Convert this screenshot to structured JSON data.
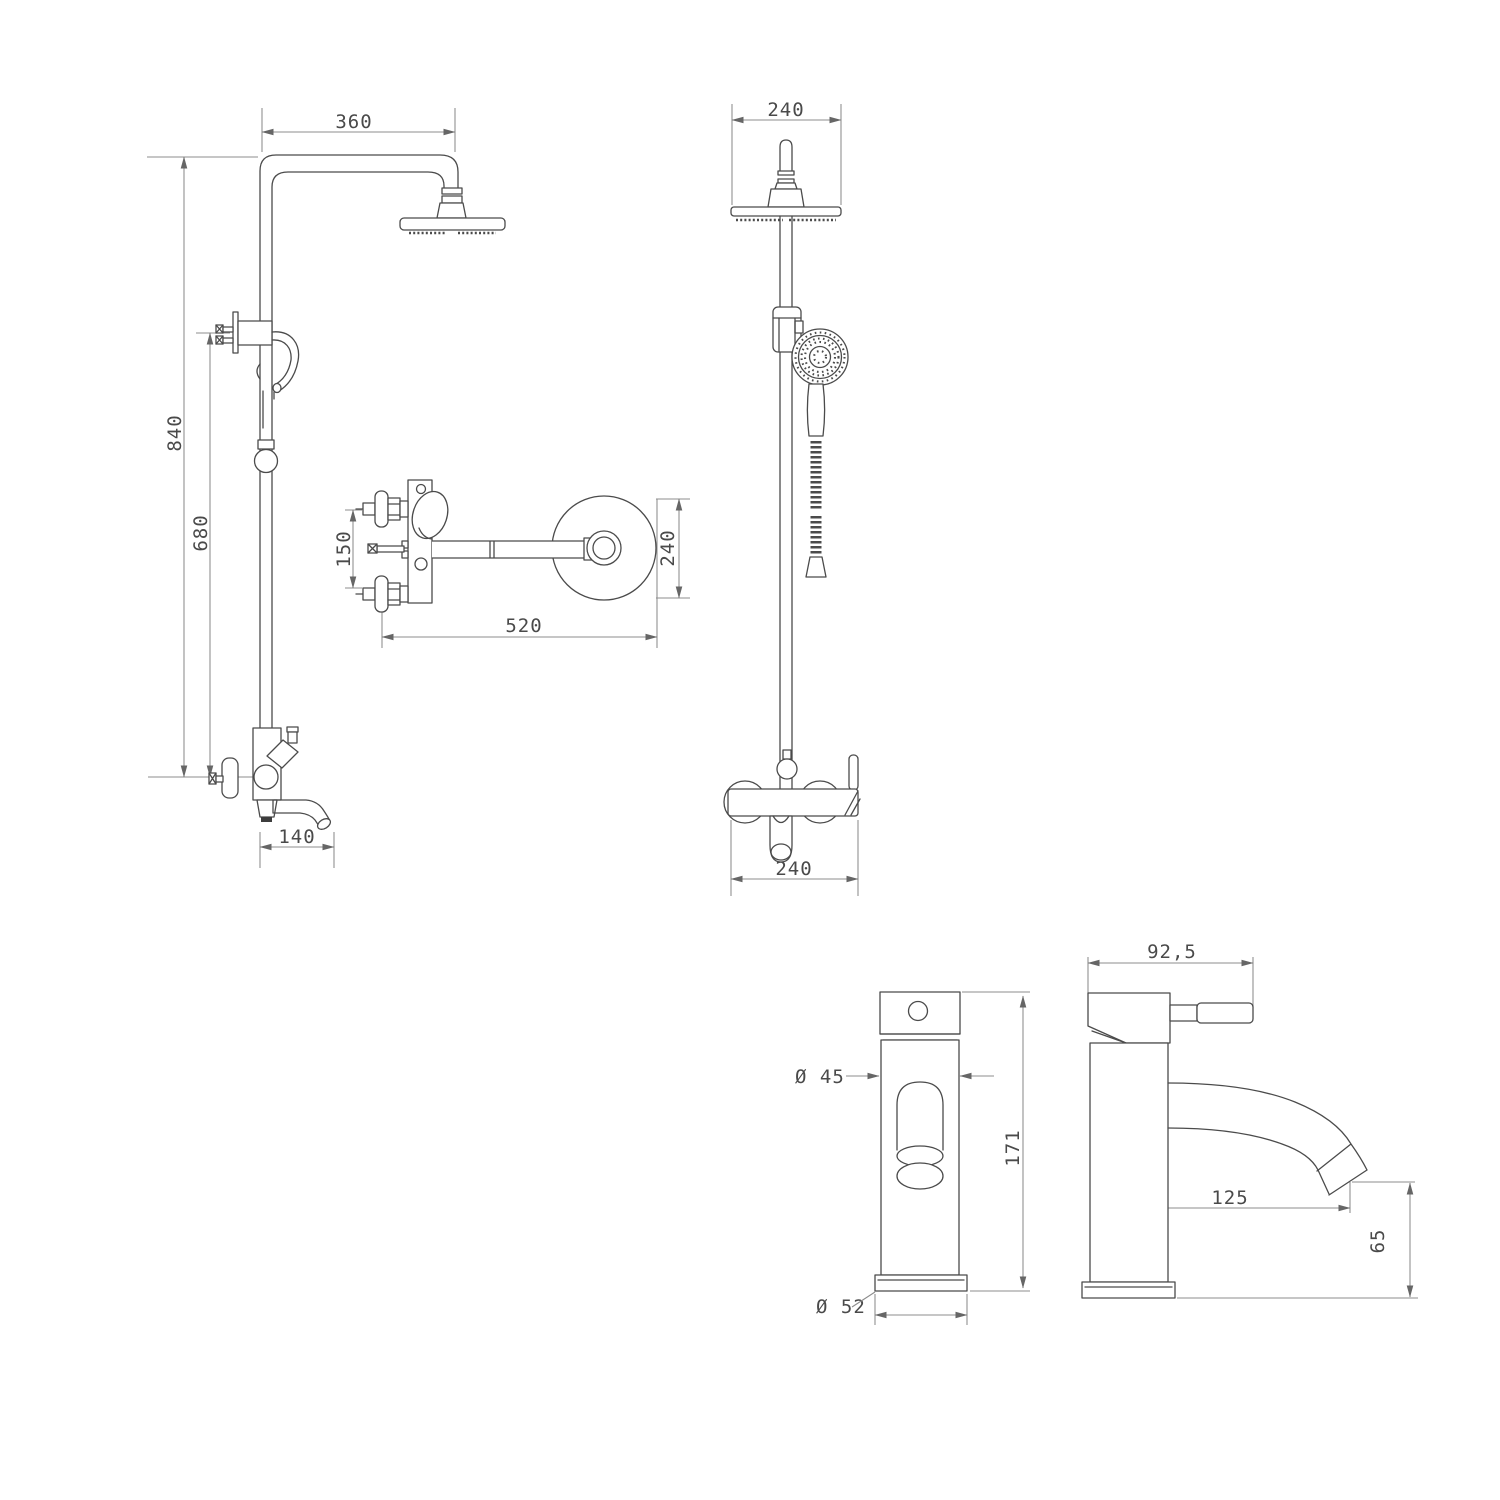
{
  "title": "faucet-and-shower-technical-drawing",
  "style": {
    "background": "#ffffff",
    "line_color": "#4b4b4b",
    "dim_line_color": "#8c8c8c",
    "text_color": "#4a4a4a",
    "aerator_color": "#3d3d3d"
  },
  "views": {
    "shower_column_side": {
      "dims": {
        "arm_width": "360",
        "overall_height": "840",
        "lower_height": "680",
        "spout_reach": "140"
      }
    },
    "wall_mixer_side": {
      "dims": {
        "inlet_spacing": "150",
        "arm_length": "520",
        "head_diameter": "240"
      }
    },
    "shower_column_front": {
      "dims": {
        "head_width": "240",
        "mixer_width": "240"
      }
    },
    "basin_faucet_front": {
      "dims": {
        "body_diameter": "Ø 45",
        "base_diameter": "Ø 52",
        "height": "171"
      }
    },
    "basin_faucet_side": {
      "dims": {
        "top_depth": "92,5",
        "spout_reach": "125",
        "spout_height": "65"
      }
    }
  }
}
